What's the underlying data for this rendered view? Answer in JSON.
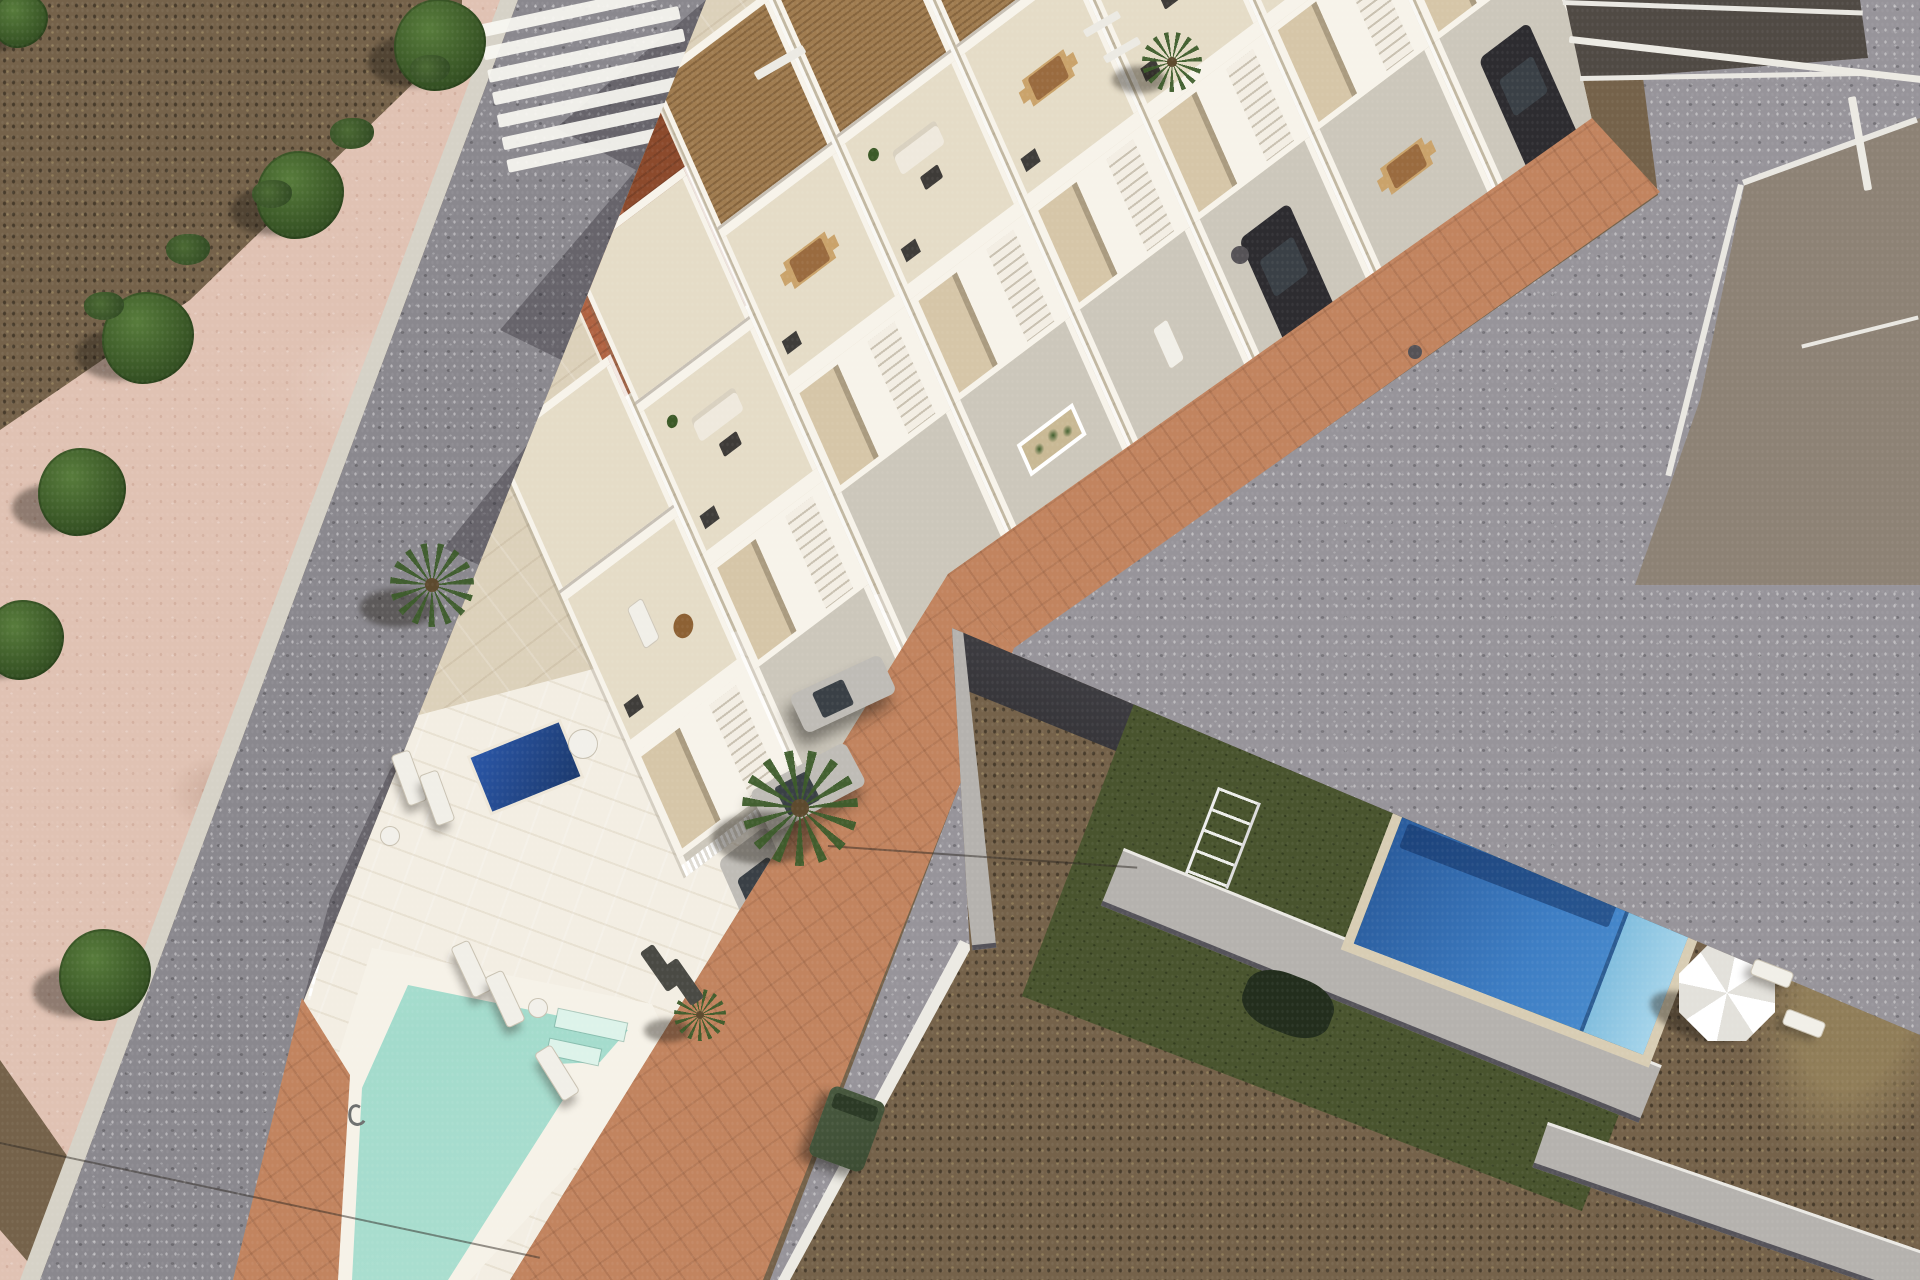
{
  "meta": {
    "description": "Aerial architectural render of a new-build row of white townhouses with roof terraces and pergolas, set along a diagonal asphalt street with a zebra crossing, a wedge-shaped community plot ending in a turquoise pool, a terracotta paver sidewalk band, and an existing neighbourhood with a royal-blue pool, artificial turf and dirt plots at lower right",
    "style": "photorealistic 3d render composited on aerial photo",
    "no_visible_text": true
  },
  "palette": {
    "dirt": "#75624a",
    "dirt_dark": "#4a3d2c",
    "dirt_light": "#97835c",
    "sand": "#e0c2b3",
    "gutter": "#d6d2c7",
    "road": "#8a888e",
    "road_right": "#97949a",
    "marking": "#eceae3",
    "band": "#c2845f",
    "parcel": "#dcd1ba",
    "wall_white": "#f7f3ea",
    "wall_tan": "#d6c6a8",
    "wood": "#a07c50",
    "wood_dark": "#86653e",
    "tile_roof": "#b06342",
    "tile_roof_dark": "#8c4a2c",
    "terrace": "#e5dcc7",
    "concrete": "#ccc7bb",
    "pool_comm_1": "#cdeee2",
    "pool_comm_2": "#a3dbcc",
    "pool_deck": "#f3eee3",
    "pool_blue_deep": "#2a5c9d",
    "pool_blue": "#3e7ec4",
    "pool_steps": "#82bede",
    "coping": "#d8cdb4",
    "plunge": "#1c3a6e",
    "turf": "#49542e",
    "gray_wall": "#b5b2ae",
    "gray_cap": "#ebe9e4",
    "charcoal": "#37363a",
    "roof_old": "#8d8275",
    "parapet": "#e9e7e1",
    "tree": "#3c5a28",
    "tree_dark": "#243c18",
    "palm": "#3d5c2b",
    "car_silver": "#bfbcb6",
    "car_dark": "#2d2c30",
    "glass": "#3a4046",
    "umbrella": "#f4f3ee",
    "bin": "#3c4c33",
    "lounger": "#f1efe8",
    "teal": "#79a79a"
  },
  "scene": {
    "crosswalk": {
      "stripes": 7
    },
    "units": [
      {
        "name": "townhouse-unit-1",
        "u": 750,
        "s": 20,
        "pergola": true,
        "terrace": "sofa",
        "court": "car-dark"
      },
      {
        "name": "townhouse-unit-2",
        "u": 600,
        "s": 20,
        "pergola": true,
        "terrace": "lounge",
        "court": "dining"
      },
      {
        "name": "townhouse-unit-3",
        "u": 450,
        "s": 20,
        "pergola": true,
        "terrace": "sofa",
        "court": "car-dark"
      },
      {
        "name": "townhouse-unit-4",
        "u": 300,
        "s": 20,
        "pergola": true,
        "terrace": "dining",
        "court": "lounger"
      },
      {
        "name": "townhouse-unit-5",
        "u": 150,
        "s": 20,
        "pergola": true,
        "terrace": "sofa",
        "court": "planter"
      },
      {
        "name": "townhouse-unit-6",
        "u": 0,
        "s": 22,
        "pergola": true,
        "terrace": "dining",
        "court": "open"
      },
      {
        "name": "townhouse-unit-7",
        "u": -150,
        "s": 112,
        "pergola": false,
        "terrace": "sofa",
        "court": "open"
      },
      {
        "name": "townhouse-unit-8",
        "u": -300,
        "s": 217,
        "pergola": false,
        "terrace": "lounger",
        "court": "car-silver"
      }
    ],
    "vehicles": [
      {
        "name": "silver-sedan",
        "x": 843,
        "y": 694,
        "angle": -25,
        "len": 100,
        "wid": 42,
        "color": "car_silver"
      },
      {
        "name": "silver-suv",
        "x": 808,
        "y": 788,
        "angle": -28,
        "len": 108,
        "wid": 48,
        "color": "car_silver"
      }
    ],
    "trees": [
      {
        "x": 440,
        "y": 45,
        "r": 46
      },
      {
        "x": 300,
        "y": 195,
        "r": 44
      },
      {
        "x": 148,
        "y": 338,
        "r": 46
      },
      {
        "x": 82,
        "y": 492,
        "r": 44
      },
      {
        "x": 24,
        "y": 640,
        "r": 40
      },
      {
        "x": 105,
        "y": 975,
        "r": 46
      },
      {
        "x": 20,
        "y": 20,
        "r": 28
      }
    ],
    "shrubs": [
      {
        "x": 430,
        "y": 75,
        "r": 20
      },
      {
        "x": 352,
        "y": 140,
        "r": 22
      },
      {
        "x": 272,
        "y": 200,
        "r": 20
      },
      {
        "x": 188,
        "y": 256,
        "r": 22
      },
      {
        "x": 104,
        "y": 312,
        "r": 20
      }
    ],
    "palms": [
      {
        "x": 800,
        "y": 808,
        "r": 58
      },
      {
        "x": 432,
        "y": 585,
        "r": 42
      },
      {
        "x": 1172,
        "y": 62,
        "r": 30
      },
      {
        "x": 700,
        "y": 1015,
        "r": 26
      }
    ],
    "community_loungers": [
      {
        "x": 400,
        "y": 752,
        "angle": -20,
        "w": 18,
        "h": 52,
        "tone": "light"
      },
      {
        "x": 428,
        "y": 772,
        "angle": -20,
        "w": 18,
        "h": 52,
        "tone": "light"
      },
      {
        "x": 462,
        "y": 942,
        "angle": -25,
        "w": 18,
        "h": 54,
        "tone": "light"
      },
      {
        "x": 496,
        "y": 972,
        "angle": -25,
        "w": 18,
        "h": 54,
        "tone": "light"
      },
      {
        "x": 548,
        "y": 1046,
        "angle": -32,
        "w": 18,
        "h": 54,
        "tone": "light"
      },
      {
        "x": 652,
        "y": 944,
        "angle": -35,
        "w": 16,
        "h": 48,
        "tone": "dark"
      },
      {
        "x": 676,
        "y": 958,
        "angle": -35,
        "w": 16,
        "h": 48,
        "tone": "dark"
      }
    ],
    "side_tables": [
      {
        "x": 390,
        "y": 836,
        "r": 9
      },
      {
        "x": 538,
        "y": 1008,
        "r": 9
      },
      {
        "x": 583,
        "y": 744,
        "r": 14
      }
    ],
    "pool_community": {
      "kind": "community lap pool, pale turquoise, wedge tip of parcel"
    },
    "pool_private_blue": {
      "kind": "existing villa pool, royal blue with steps",
      "coping": "sand stone"
    },
    "plunge_pool": {
      "kind": "small private plunge pool, deep blue"
    },
    "umbrella": {
      "x": 1679,
      "y": 945,
      "size": 96
    },
    "white_chairs_br": [
      {
        "x": 1752,
        "y": 966,
        "angle": 21
      },
      {
        "x": 1784,
        "y": 1016,
        "angle": 21
      }
    ],
    "waste_bin": {
      "x": 818,
      "y": 1092
    },
    "existing_buildings": [
      "flat-roof block top-right",
      "large old rooftop right edge"
    ],
    "markings": {
      "dashes": [
        {
          "x": 752,
          "y": 58,
          "w": 56,
          "h": 9,
          "angle": -30
        },
        {
          "x": 1082,
          "y": 20,
          "w": 40,
          "h": 8,
          "angle": -30
        },
        {
          "x": 1102,
          "y": 46,
          "w": 40,
          "h": 8,
          "angle": -30
        },
        {
          "x": 1568,
          "y": 56,
          "w": 356,
          "h": 7,
          "angle": 6.5
        },
        {
          "x": 1856,
          "y": 96,
          "w": 8,
          "h": 95,
          "angle": -10
        }
      ],
      "manholes": [
        {
          "x": 1240,
          "y": 255,
          "r": 9
        },
        {
          "x": 1415,
          "y": 352,
          "r": 7
        }
      ]
    },
    "cables": [
      {
        "x": 0,
        "y": 1142,
        "len": 552,
        "angle": 12
      },
      {
        "x": 828,
        "y": 845,
        "len": 310,
        "angle": 4
      }
    ]
  }
}
